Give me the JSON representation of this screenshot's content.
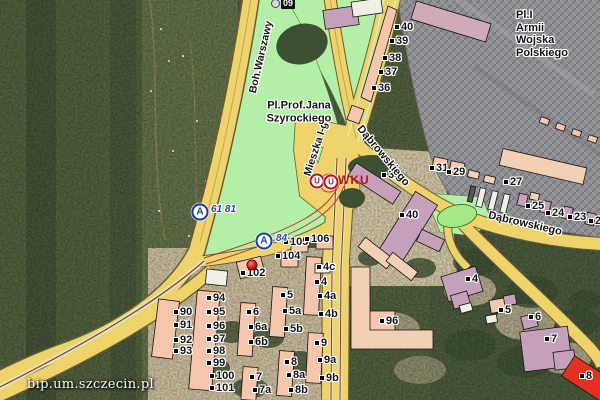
{
  "map": {
    "watermark": "bip.um.szczecin.pl",
    "colors": {
      "road": "#eed26a",
      "park": "#b4efa8",
      "median_green": "#cbefc2",
      "tram_red": "#c22222",
      "building_pink": "#f6c6ac",
      "building_mauve": "#c5a0ba",
      "building_tan": "#f2d0b4",
      "building_red": "#e6301f",
      "hatch_base": "#8e8e92",
      "forest": "#52603f",
      "pond": "#a5e987",
      "bus_blue": "#1d3ca8",
      "poi_red": "#c01020",
      "label": "#141414"
    },
    "icons": {
      "bus_letter": "A",
      "office_letter": "U"
    },
    "area_labels": [
      {
        "lines": [
          "Pl.Prof.Jana",
          "Szyrockiego"
        ],
        "x": 299,
        "y": 112,
        "align": "center"
      },
      {
        "lines": [
          "Pl.I",
          "Armii",
          "Wojska",
          "Polskiego"
        ],
        "x": 516,
        "y": 9,
        "align": "left"
      }
    ],
    "street_labels": [
      {
        "text": "Boh.Warszawy",
        "x": 261,
        "y": 57,
        "rot": -77,
        "size": 10.5
      },
      {
        "text": "Mieszka I-go",
        "x": 317,
        "y": 146,
        "rot": -72,
        "size": 10.5
      },
      {
        "text": "Dąbrowskiego",
        "x": 383,
        "y": 156,
        "rot": 50,
        "size": 11
      },
      {
        "text": "Dąbrowskiego",
        "x": 525,
        "y": 224,
        "rot": 13,
        "size": 11
      }
    ],
    "number_labels": [
      {
        "t": "40",
        "x": 395,
        "y": 21
      },
      {
        "t": "39",
        "x": 390,
        "y": 35
      },
      {
        "t": "38",
        "x": 383,
        "y": 52
      },
      {
        "t": "37",
        "x": 379,
        "y": 66
      },
      {
        "t": "36",
        "x": 372,
        "y": 82
      },
      {
        "t": "38",
        "x": 382,
        "y": 169
      },
      {
        "t": "40",
        "x": 400,
        "y": 209
      },
      {
        "t": "31",
        "x": 430,
        "y": 162
      },
      {
        "t": "29",
        "x": 447,
        "y": 166
      },
      {
        "t": "27",
        "x": 504,
        "y": 176
      },
      {
        "t": "25",
        "x": 526,
        "y": 200
      },
      {
        "t": "24",
        "x": 546,
        "y": 207
      },
      {
        "t": "23",
        "x": 568,
        "y": 211
      },
      {
        "t": "22",
        "x": 589,
        "y": 215
      },
      {
        "t": "90",
        "x": 174,
        "y": 306
      },
      {
        "t": "91",
        "x": 174,
        "y": 319
      },
      {
        "t": "92",
        "x": 174,
        "y": 334
      },
      {
        "t": "93",
        "x": 174,
        "y": 345
      },
      {
        "t": "94",
        "x": 207,
        "y": 292
      },
      {
        "t": "95",
        "x": 207,
        "y": 306
      },
      {
        "t": "96",
        "x": 207,
        "y": 320
      },
      {
        "t": "97",
        "x": 207,
        "y": 333
      },
      {
        "t": "98",
        "x": 207,
        "y": 345
      },
      {
        "t": "99",
        "x": 207,
        "y": 357
      },
      {
        "t": "100",
        "x": 210,
        "y": 370
      },
      {
        "t": "101",
        "x": 210,
        "y": 382
      },
      {
        "t": "6",
        "x": 247,
        "y": 306
      },
      {
        "t": "6a",
        "x": 249,
        "y": 321
      },
      {
        "t": "6b",
        "x": 249,
        "y": 336
      },
      {
        "t": "5",
        "x": 281,
        "y": 289
      },
      {
        "t": "5a",
        "x": 283,
        "y": 305
      },
      {
        "t": "5b",
        "x": 284,
        "y": 323
      },
      {
        "t": "4c",
        "x": 317,
        "y": 261
      },
      {
        "t": "4",
        "x": 315,
        "y": 276
      },
      {
        "t": "4a",
        "x": 318,
        "y": 290
      },
      {
        "t": "4b",
        "x": 319,
        "y": 308
      },
      {
        "t": "7",
        "x": 250,
        "y": 371
      },
      {
        "t": "7a",
        "x": 253,
        "y": 384
      },
      {
        "t": "8",
        "x": 285,
        "y": 356
      },
      {
        "t": "8a",
        "x": 287,
        "y": 369
      },
      {
        "t": "8b",
        "x": 289,
        "y": 384
      },
      {
        "t": "9",
        "x": 315,
        "y": 337
      },
      {
        "t": "9a",
        "x": 318,
        "y": 354
      },
      {
        "t": "9b",
        "x": 320,
        "y": 372
      },
      {
        "t": "102",
        "x": 241,
        "y": 267
      },
      {
        "t": "104",
        "x": 276,
        "y": 250
      },
      {
        "t": "105",
        "x": 284,
        "y": 236
      },
      {
        "t": "106",
        "x": 305,
        "y": 233
      },
      {
        "t": "96",
        "x": 380,
        "y": 315
      },
      {
        "t": "4",
        "x": 466,
        "y": 273
      },
      {
        "t": "5",
        "x": 499,
        "y": 304
      },
      {
        "t": "6",
        "x": 529,
        "y": 311
      },
      {
        "t": "7",
        "x": 545,
        "y": 333
      },
      {
        "t": "8",
        "x": 580,
        "y": 370
      }
    ],
    "bus_stops": [
      {
        "x": 200,
        "y": 212,
        "label": "61 81",
        "lx": 211,
        "ly": 204
      },
      {
        "x": 264,
        "y": 241,
        "label": "84",
        "lx": 276,
        "ly": 233
      }
    ],
    "office_poi": {
      "circles": [
        {
          "x": 317,
          "y": 181
        },
        {
          "x": 331,
          "y": 182
        }
      ],
      "label": "WKU",
      "lx": 338,
      "ly": 174
    },
    "red_marker": {
      "x": 252,
      "y": 265
    },
    "route_badge": {
      "text": "09",
      "x": 271,
      "y": -2
    }
  }
}
